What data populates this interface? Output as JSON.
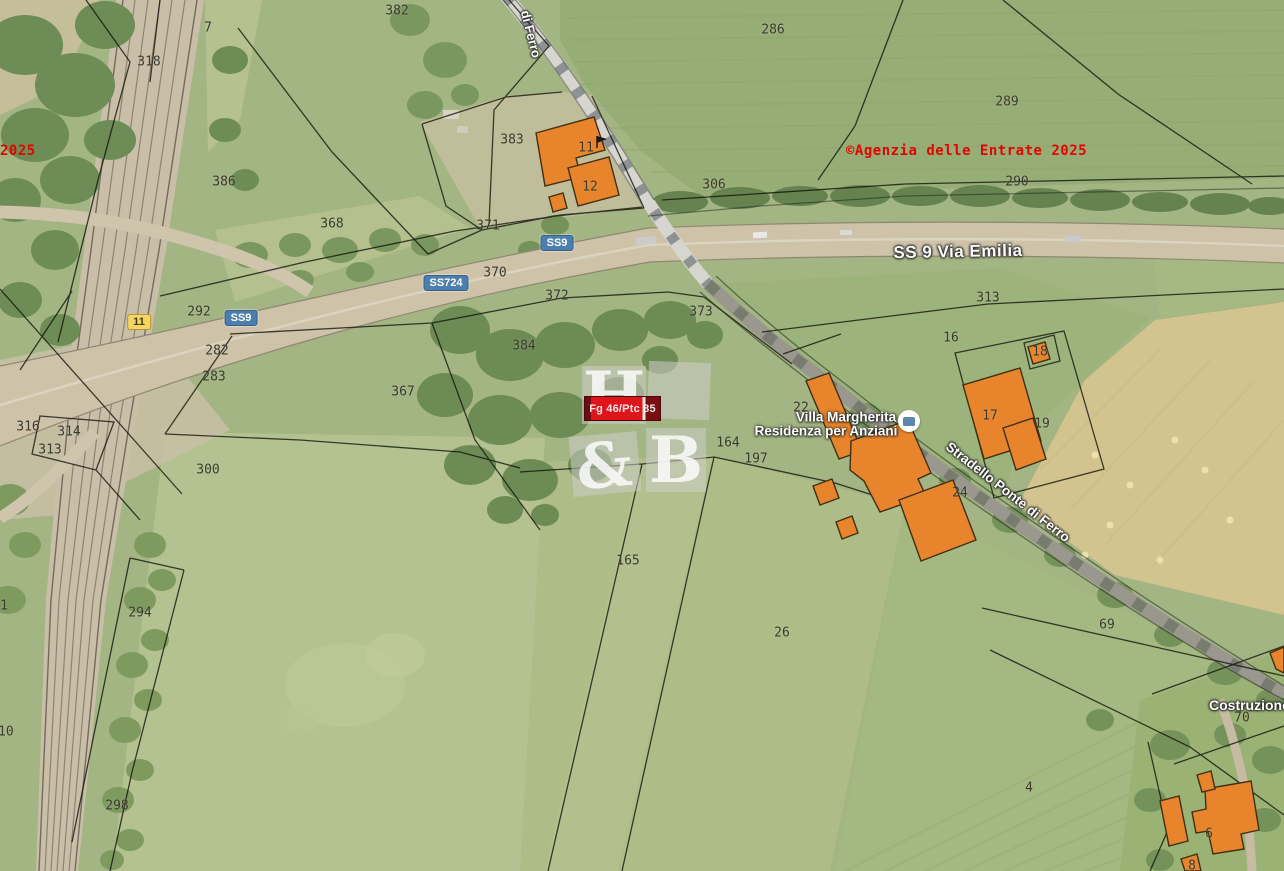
{
  "map": {
    "attribution": {
      "text": "©Agenzia delle Entrate 2025",
      "partial_left_text": "2025",
      "color": "#e20400"
    },
    "highlight": {
      "label": "Fg 46/Ptc 85",
      "color": "#e0151c"
    },
    "watermark": {
      "letter_h": "H",
      "letter_amp": "&",
      "letter_b": "B"
    },
    "roads": {
      "main_road_label": "SS 9 Via Emilia",
      "stradello_label": "Stradello Ponte di Ferro",
      "stradello_top_label": "di Ferro",
      "construction_label": "Costruzione"
    },
    "place": {
      "name_line1": "Villa Margherita",
      "name_line2": "Residenza per Anziani"
    },
    "badges": [
      {
        "text": "SS9",
        "type": "blue",
        "x": 557,
        "y": 243
      },
      {
        "text": "SS724",
        "type": "blue",
        "x": 446,
        "y": 283
      },
      {
        "text": "SS9",
        "type": "blue",
        "x": 241,
        "y": 318
      },
      {
        "text": "11",
        "type": "yellow",
        "x": 139,
        "y": 322
      }
    ],
    "parcels": [
      {
        "label": "382",
        "x": 397,
        "y": 11
      },
      {
        "label": "7",
        "x": 208,
        "y": 28
      },
      {
        "label": "318",
        "x": 149,
        "y": 62
      },
      {
        "label": "386",
        "x": 224,
        "y": 182
      },
      {
        "label": "368",
        "x": 332,
        "y": 224
      },
      {
        "label": "383",
        "x": 512,
        "y": 140
      },
      {
        "label": "11",
        "x": 586,
        "y": 148
      },
      {
        "label": "12",
        "x": 590,
        "y": 187
      },
      {
        "label": "306",
        "x": 714,
        "y": 185
      },
      {
        "label": "371",
        "x": 488,
        "y": 226
      },
      {
        "label": "370",
        "x": 495,
        "y": 273
      },
      {
        "label": "372",
        "x": 557,
        "y": 296
      },
      {
        "label": "373",
        "x": 701,
        "y": 312
      },
      {
        "label": "384",
        "x": 524,
        "y": 346
      },
      {
        "label": "367",
        "x": 403,
        "y": 392
      },
      {
        "label": "292",
        "x": 199,
        "y": 312
      },
      {
        "label": "282",
        "x": 217,
        "y": 351
      },
      {
        "label": "283",
        "x": 214,
        "y": 377
      },
      {
        "label": "286",
        "x": 773,
        "y": 30
      },
      {
        "label": "289",
        "x": 1007,
        "y": 102
      },
      {
        "label": "290",
        "x": 1017,
        "y": 182
      },
      {
        "label": "313",
        "x": 988,
        "y": 298
      },
      {
        "label": "16",
        "x": 951,
        "y": 338
      },
      {
        "label": "18",
        "x": 1040,
        "y": 352
      },
      {
        "label": "17",
        "x": 990,
        "y": 416
      },
      {
        "label": "19",
        "x": 1042,
        "y": 424
      },
      {
        "label": "22",
        "x": 801,
        "y": 408
      },
      {
        "label": "164",
        "x": 728,
        "y": 443
      },
      {
        "label": "197",
        "x": 756,
        "y": 459
      },
      {
        "label": "24",
        "x": 960,
        "y": 493
      },
      {
        "label": "316",
        "x": 28,
        "y": 427
      },
      {
        "label": "314",
        "x": 69,
        "y": 432
      },
      {
        "label": "313",
        "x": 50,
        "y": 450
      },
      {
        "label": "300",
        "x": 208,
        "y": 470
      },
      {
        "label": "294",
        "x": 140,
        "y": 613
      },
      {
        "label": "298",
        "x": 117,
        "y": 806
      },
      {
        "label": "165",
        "x": 628,
        "y": 561
      },
      {
        "label": "26",
        "x": 782,
        "y": 633
      },
      {
        "label": "69",
        "x": 1107,
        "y": 625
      },
      {
        "label": "4",
        "x": 1029,
        "y": 788
      },
      {
        "label": "70",
        "x": 1242,
        "y": 718
      },
      {
        "label": "1",
        "x": 4,
        "y": 606
      },
      {
        "label": "310",
        "x": 2,
        "y": 732
      },
      {
        "label": "6",
        "x": 1209,
        "y": 834
      },
      {
        "label": "8",
        "x": 1192,
        "y": 866
      }
    ],
    "colors": {
      "field_green": "#a3b583",
      "harvested_tan": "#d3c48f",
      "building_orange": "#e8842b",
      "road_tan": "#cec3a9",
      "badge_blue": "#4d7fae",
      "badge_yellow": "#f5d566"
    }
  }
}
